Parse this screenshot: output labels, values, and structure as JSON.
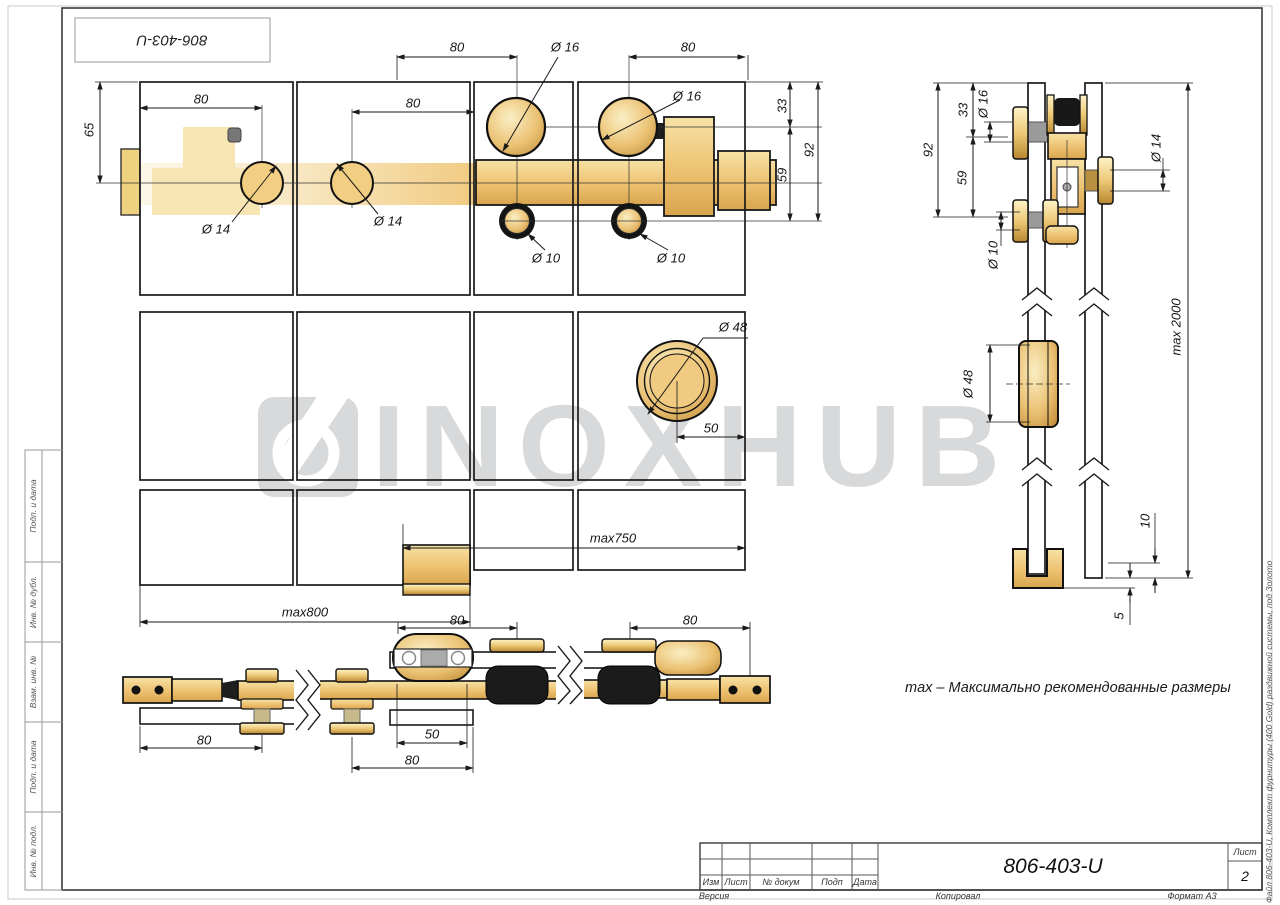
{
  "stamp": {
    "text": "806-403-U"
  },
  "watermark": {
    "text": "INOXHUB"
  },
  "note": {
    "text": "max – Максимально рекомендованные размеры"
  },
  "front_view": {
    "dims": {
      "span_top_left": "80",
      "span_top_right": "80",
      "roller_dia_1": "Ø 16",
      "roller_dia_2": "Ø 16",
      "h33": "33",
      "h92": "92",
      "h59": "59",
      "h65": "65",
      "offset_left": "80",
      "offset_mid": "80",
      "bolt_dia_1": "Ø 14",
      "bolt_dia_2": "Ø 14",
      "guide_dia_1": "Ø 10",
      "guide_dia_2": "Ø 10",
      "handle_dia": "Ø 48",
      "handle_offset": "50",
      "max750": "max750",
      "max800": "max800"
    }
  },
  "side_view": {
    "dims": {
      "h92": "92",
      "h33": "33",
      "roller_dia": "Ø 16",
      "h59": "59",
      "guide_dia": "Ø 10",
      "wall_roller_dia": "Ø 14",
      "handle_dia": "Ø 48",
      "max_height": "max 2000",
      "gap10": "10",
      "gap5": "5"
    }
  },
  "plan_view": {
    "dims": {
      "left80": "80",
      "mid80": "80",
      "right80": "80",
      "guide50": "50",
      "guide80": "80"
    }
  },
  "sidebar": {
    "items": [
      "Подп. и дата",
      "Инв. № дубл.",
      "Взам. инв. №",
      "Подп. и дата",
      "Инв. № подл."
    ]
  },
  "title_block": {
    "designation": "806-403-U",
    "cols": {
      "izm": "Изм",
      "list": "Лист",
      "doc": "№ докум",
      "podp": "Подп",
      "data": "Дата"
    },
    "sheet_label": "Лист",
    "sheet_number": "2",
    "version_label": "Версия",
    "copied_label": "Копировал",
    "format_label": "Формат А3",
    "file_note": "Файл 806-403-U, Комплект фурнитуры (400 Gold) раздвижной системы, под Золото"
  }
}
